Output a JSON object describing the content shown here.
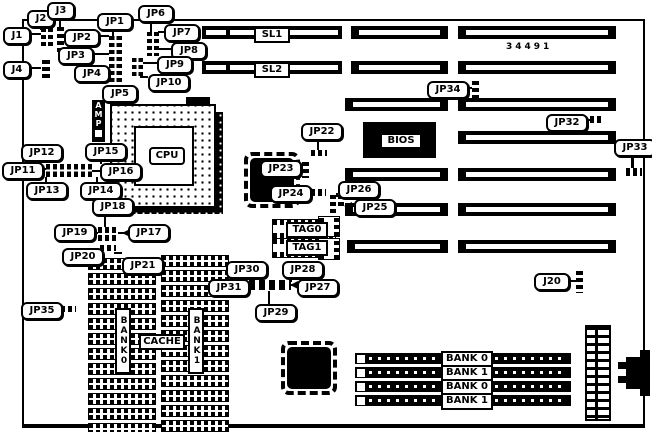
{
  "part_number": "34491",
  "callouts": {
    "j1": "J1",
    "j2": "J2",
    "j3": "J3",
    "j4": "J4",
    "j20": "J20",
    "jp1": "JP1",
    "jp2": "JP2",
    "jp3": "JP3",
    "jp4": "JP4",
    "jp5": "JP5",
    "jp6": "JP6",
    "jp7": "JP7",
    "jp8": "JP8",
    "jp9": "JP9",
    "jp10": "JP10",
    "jp11": "JP11",
    "jp12": "JP12",
    "jp13": "JP13",
    "jp14": "JP14",
    "jp15": "JP15",
    "jp16": "JP16",
    "jp17": "JP17",
    "jp18": "JP18",
    "jp19": "JP19",
    "jp20": "JP20",
    "jp21": "JP21",
    "jp22": "JP22",
    "jp23": "JP23",
    "jp24": "JP24",
    "jp25": "JP25",
    "jp26": "JP26",
    "jp27": "JP27",
    "jp28": "JP28",
    "jp29": "JP29",
    "jp30": "JP30",
    "jp31": "JP31",
    "jp32": "JP32",
    "jp33": "JP33",
    "jp34": "JP34",
    "jp35": "JP35"
  },
  "slots": {
    "sl1": "SL1",
    "sl2": "SL2"
  },
  "chips": {
    "cpu": "CPU",
    "bios": "BIOS",
    "amp": "AMP",
    "tag0": "TAG0",
    "tag1": "TAG1",
    "cache": "CACHE",
    "cache_bank0": "BANK0",
    "cache_bank1": "BANK1"
  },
  "simm": {
    "labels": [
      "BANK 0",
      "BANK 1",
      "BANK 0",
      "BANK 1"
    ]
  },
  "colors": {
    "ink": "#000000",
    "paper": "#ffffff"
  }
}
